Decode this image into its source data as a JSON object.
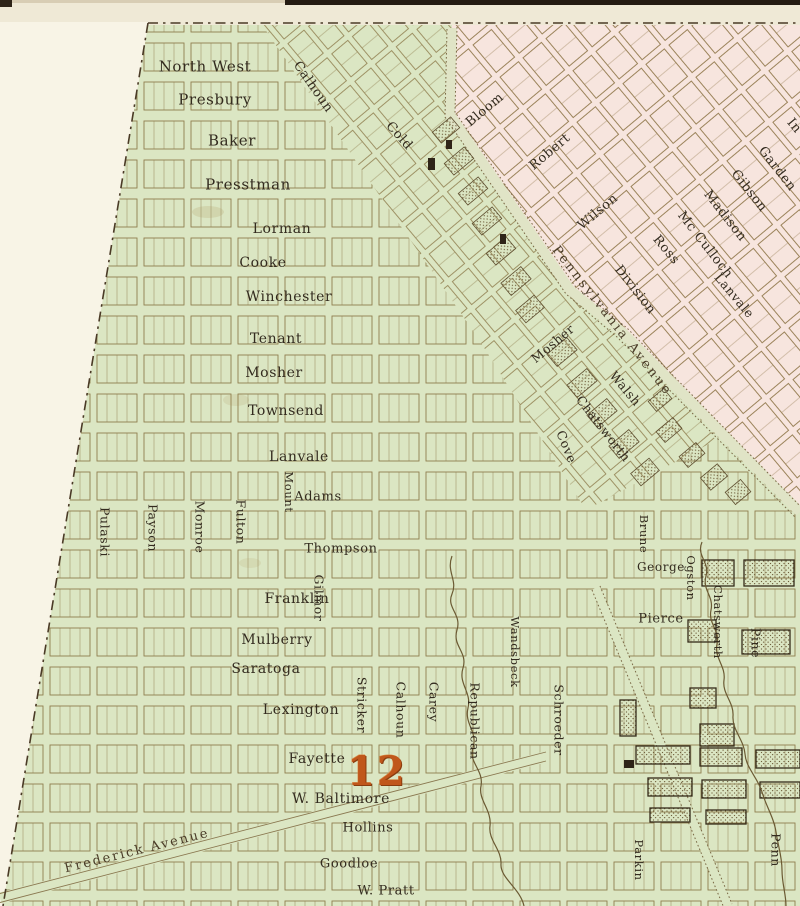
{
  "map": {
    "description": "engraved city plan sheet, district 12, green and pink wards",
    "district_number": "12",
    "colors": {
      "paper": "#efe9d6",
      "margin": "#f8f4e6",
      "green_ward": "#dbe6c3",
      "pink_ward": "#f7e5de",
      "ink": "#332b1f",
      "gridline": "#8f7d4d",
      "boundary": "#4a3a26",
      "stream": "#6b5a33",
      "district_orange": "#c0571b"
    },
    "labels": [
      {
        "text": "North West",
        "x": 205,
        "y": 67,
        "rot": 0,
        "size": 15
      },
      {
        "text": "Presbury",
        "x": 215,
        "y": 100,
        "rot": 0,
        "size": 15
      },
      {
        "text": "Baker",
        "x": 232,
        "y": 141,
        "rot": 0,
        "size": 15
      },
      {
        "text": "Presstman",
        "x": 248,
        "y": 185,
        "rot": 0,
        "size": 15
      },
      {
        "text": "Lorman",
        "x": 282,
        "y": 229,
        "rot": 0,
        "size": 14
      },
      {
        "text": "Cooke",
        "x": 263,
        "y": 263,
        "rot": 0,
        "size": 14
      },
      {
        "text": "Winchester",
        "x": 289,
        "y": 297,
        "rot": 0,
        "size": 14
      },
      {
        "text": "Tenant",
        "x": 276,
        "y": 339,
        "rot": 0,
        "size": 14
      },
      {
        "text": "Mosher",
        "x": 274,
        "y": 373,
        "rot": 0,
        "size": 14
      },
      {
        "text": "Townsend",
        "x": 286,
        "y": 411,
        "rot": 0,
        "size": 14
      },
      {
        "text": "Lanvale",
        "x": 299,
        "y": 457,
        "rot": 0,
        "size": 14
      },
      {
        "text": "Adams",
        "x": 318,
        "y": 497,
        "rot": 0,
        "size": 13
      },
      {
        "text": "Thompson",
        "x": 341,
        "y": 549,
        "rot": 0,
        "size": 13
      },
      {
        "text": "Franklin",
        "x": 297,
        "y": 599,
        "rot": 0,
        "size": 14
      },
      {
        "text": "Mulberry",
        "x": 277,
        "y": 640,
        "rot": 0,
        "size": 14
      },
      {
        "text": "Saratoga",
        "x": 266,
        "y": 669,
        "rot": 0,
        "size": 14
      },
      {
        "text": "Lexington",
        "x": 301,
        "y": 710,
        "rot": 0,
        "size": 14
      },
      {
        "text": "Fayette",
        "x": 317,
        "y": 759,
        "rot": 0,
        "size": 14
      },
      {
        "text": "W. Baltimore",
        "x": 341,
        "y": 799,
        "rot": 0,
        "size": 14
      },
      {
        "text": "Hollins",
        "x": 368,
        "y": 828,
        "rot": 0,
        "size": 13
      },
      {
        "text": "Goodloe",
        "x": 349,
        "y": 864,
        "rot": 0,
        "size": 13
      },
      {
        "text": "W. Pratt",
        "x": 386,
        "y": 891,
        "rot": 0,
        "size": 13
      },
      {
        "text": "George",
        "x": 661,
        "y": 567,
        "rot": 0,
        "size": 12
      },
      {
        "text": "Pierce",
        "x": 661,
        "y": 619,
        "rot": 0,
        "size": 13
      },
      {
        "text": "Pulaski",
        "x": 104,
        "y": 532,
        "rot": 90,
        "size": 12.5
      },
      {
        "text": "Payson",
        "x": 152,
        "y": 528,
        "rot": 90,
        "size": 12.5
      },
      {
        "text": "Monroe",
        "x": 199,
        "y": 527,
        "rot": 90,
        "size": 12.5
      },
      {
        "text": "Fulton",
        "x": 240,
        "y": 522,
        "rot": 90,
        "size": 12.5
      },
      {
        "text": "Mount",
        "x": 288,
        "y": 492,
        "rot": 90,
        "size": 11.5
      },
      {
        "text": "Gilmor",
        "x": 318,
        "y": 598,
        "rot": 90,
        "size": 12.5
      },
      {
        "text": "Stricker",
        "x": 361,
        "y": 705,
        "rot": 90,
        "size": 12.5
      },
      {
        "text": "Calhoun",
        "x": 400,
        "y": 710,
        "rot": 90,
        "size": 12.5
      },
      {
        "text": "Carey",
        "x": 433,
        "y": 702,
        "rot": 90,
        "size": 12.5
      },
      {
        "text": "Republican",
        "x": 474,
        "y": 721,
        "rot": 90,
        "size": 12.5
      },
      {
        "text": "Wandsbeck",
        "x": 514,
        "y": 652,
        "rot": 90,
        "size": 11.5
      },
      {
        "text": "Schroeder",
        "x": 558,
        "y": 720,
        "rot": 90,
        "size": 12.5
      },
      {
        "text": "Brune",
        "x": 643,
        "y": 534,
        "rot": 90,
        "size": 11.5
      },
      {
        "text": "Ogston",
        "x": 690,
        "y": 578,
        "rot": 90,
        "size": 11.5
      },
      {
        "text": "Chatsworth",
        "x": 717,
        "y": 622,
        "rot": 90,
        "size": 11.5
      },
      {
        "text": "Pine",
        "x": 755,
        "y": 643,
        "rot": 90,
        "size": 12.5
      },
      {
        "text": "Parkin",
        "x": 638,
        "y": 860,
        "rot": 90,
        "size": 11.5
      },
      {
        "text": "Penn",
        "x": 775,
        "y": 850,
        "rot": 90,
        "size": 12.5
      },
      {
        "text": "Bloom",
        "x": 485,
        "y": 110,
        "rot": -40,
        "size": 13
      },
      {
        "text": "Robert",
        "x": 550,
        "y": 152,
        "rot": -40,
        "size": 13
      },
      {
        "text": "Wilson",
        "x": 598,
        "y": 212,
        "rot": -40,
        "size": 13
      },
      {
        "text": "Mosher",
        "x": 553,
        "y": 344,
        "rot": -40,
        "size": 12.5
      },
      {
        "text": "Calhoun",
        "x": 313,
        "y": 87,
        "rot": 55,
        "size": 13
      },
      {
        "text": "Cold",
        "x": 399,
        "y": 136,
        "rot": 48,
        "size": 13
      },
      {
        "text": "Madison",
        "x": 725,
        "y": 216,
        "rot": 52,
        "size": 13
      },
      {
        "text": "Mc Culloch",
        "x": 705,
        "y": 245,
        "rot": 52,
        "size": 13
      },
      {
        "text": "Ross",
        "x": 666,
        "y": 250,
        "rot": 50,
        "size": 13
      },
      {
        "text": "Division",
        "x": 635,
        "y": 290,
        "rot": 52,
        "size": 13
      },
      {
        "text": "Garden",
        "x": 777,
        "y": 169,
        "rot": 52,
        "size": 13
      },
      {
        "text": "Gibson",
        "x": 749,
        "y": 191,
        "rot": 52,
        "size": 13
      },
      {
        "text": "Lanvale",
        "x": 734,
        "y": 296,
        "rot": 50,
        "size": 12.5
      },
      {
        "text": "Walsh",
        "x": 625,
        "y": 389,
        "rot": 50,
        "size": 12.5
      },
      {
        "text": "Chatsworth",
        "x": 603,
        "y": 429,
        "rot": 52,
        "size": 12.5
      },
      {
        "text": "Cove",
        "x": 566,
        "y": 447,
        "rot": 68,
        "size": 12.5
      },
      {
        "text": "In",
        "x": 794,
        "y": 126,
        "rot": 50,
        "size": 13,
        "kind": "street-label-partial"
      },
      {
        "text": "Pennsylvania Avenue",
        "x": 612,
        "y": 321,
        "rot": 52,
        "size": 13,
        "sp": 2.5,
        "cls": "avenue",
        "kind": "avenue-label"
      },
      {
        "text": "Frederick Avenue",
        "x": 137,
        "y": 851,
        "rot": -14,
        "size": 13,
        "sp": 2,
        "cls": "avenue",
        "kind": "avenue-label"
      },
      {
        "text": "12",
        "x": 377,
        "y": 772,
        "rot": 0,
        "size": 40,
        "cls": "district",
        "kind": "district-number-label"
      }
    ]
  }
}
